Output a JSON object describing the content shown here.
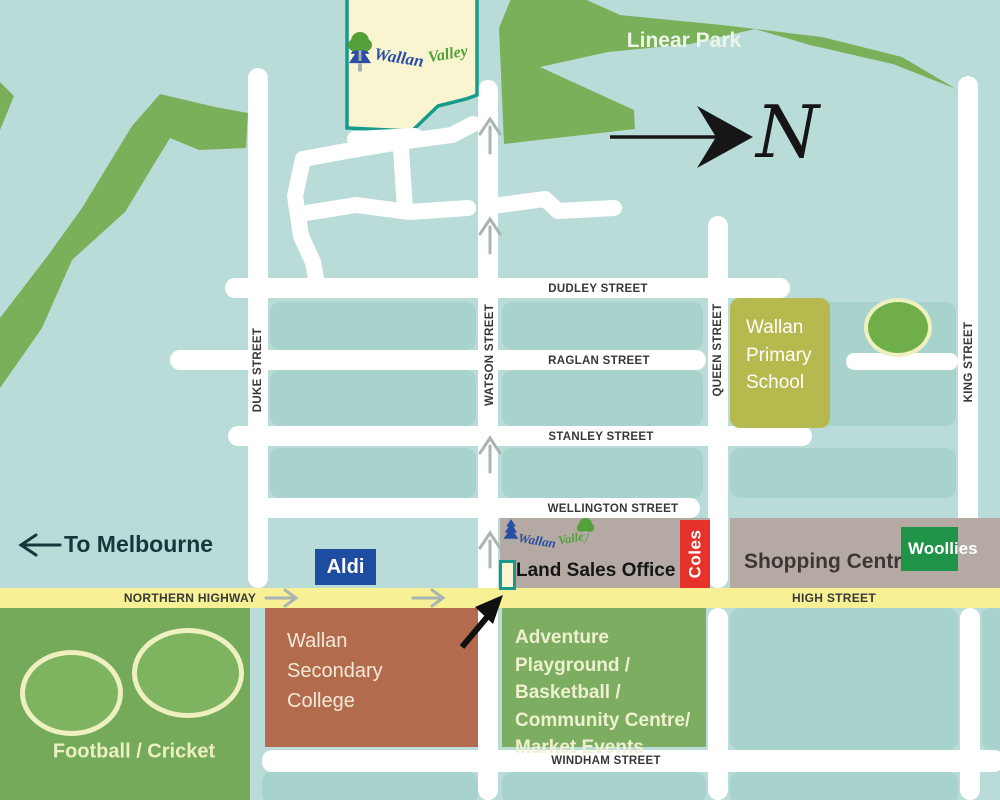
{
  "legend": {
    "north": "N",
    "to_melbourne": "To Melbourne"
  },
  "estate": {
    "logo_word1": "Wallan",
    "logo_word2": "Valley"
  },
  "parks": {
    "linear_park": "Linear Park",
    "football_cricket": "Football / Cricket"
  },
  "streets": {
    "dudley": "DUDLEY STREET",
    "raglan": "RAGLAN STREET",
    "stanley": "STANLEY STREET",
    "wellington": "WELLINGTON STREET",
    "windham": "WINDHAM STREET",
    "northern_highway": "NORTHERN HIGHWAY",
    "high": "HIGH STREET",
    "duke": "DUKE STREET",
    "watson": "WATSON STREET",
    "queen": "QUEEN STREET",
    "king": "KING STREET"
  },
  "places": {
    "primary_school": "Wallan Primary School",
    "secondary_college": "Wallan Secondary College",
    "playground": "Adventure Playground / Basketball / Community Centre/ Market Events",
    "shopping_centre": "Shopping Centre",
    "land_sales_office": "Land Sales Office",
    "aldi": "Aldi",
    "coles": "Coles",
    "woollies": "Woollies"
  },
  "colors": {
    "bg_teal": "#badcd8",
    "block_teal": "#a8d2cc",
    "park_green": "#7bb05a",
    "field_green": "#74aa59",
    "oval_green": "#7eb35f",
    "oval_cream": "#eef0c0",
    "highway_yellow": "#f7f094",
    "estate_cream": "#f8f5d0",
    "estate_teal": "#189a8b",
    "school_olive": "#b6b94d",
    "college_terracotta": "#b36b4d",
    "playground_green": "#7cad60",
    "shop_grey": "#b5aaa3",
    "aldi_blue": "#1d4da1",
    "coles_red": "#e5332b",
    "woollies_green": "#1f9347",
    "logo_blue": "#2a4da5",
    "logo_green": "#55a139",
    "dark_text": "#12393b",
    "street_text": "#383838",
    "arrow_grey": "#a8b5b2"
  }
}
